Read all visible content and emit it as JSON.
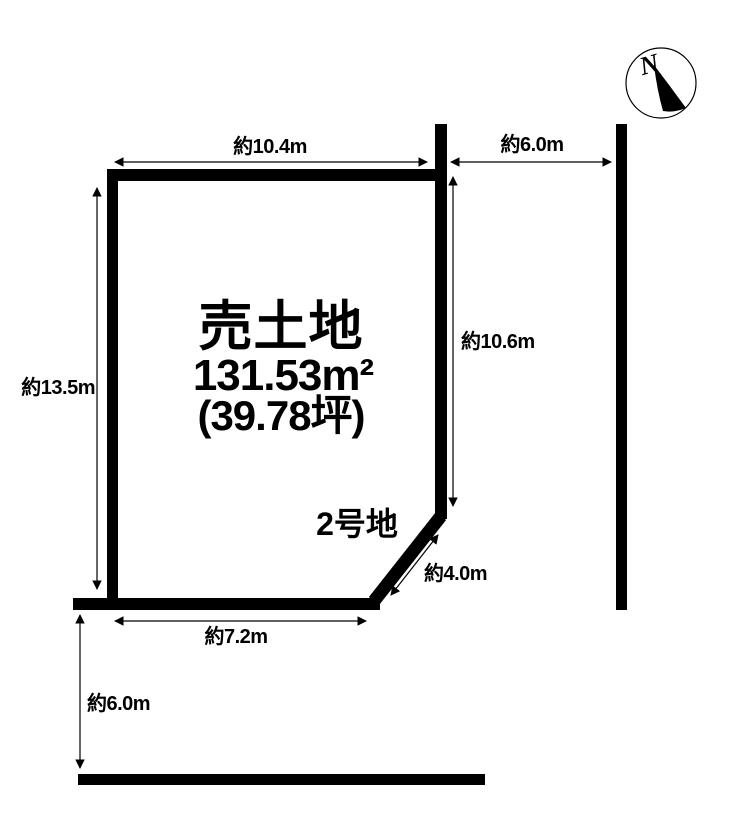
{
  "page": {
    "background": "#ffffff",
    "line_color": "#000000"
  },
  "plot": {
    "title": "売土地",
    "area_sqm": "131.53m²",
    "area_tsubo": "(39.78坪)",
    "lot_number": "2号地"
  },
  "dimensions": {
    "north_width": "約10.4m",
    "east_road_width": "約6.0m",
    "west_depth": "約13.5m",
    "east_depth": "約10.6m",
    "corner_cut": "約4.0m",
    "south_width": "約7.2m",
    "south_road_width": "約6.0m"
  },
  "compass": {
    "label": "N"
  }
}
